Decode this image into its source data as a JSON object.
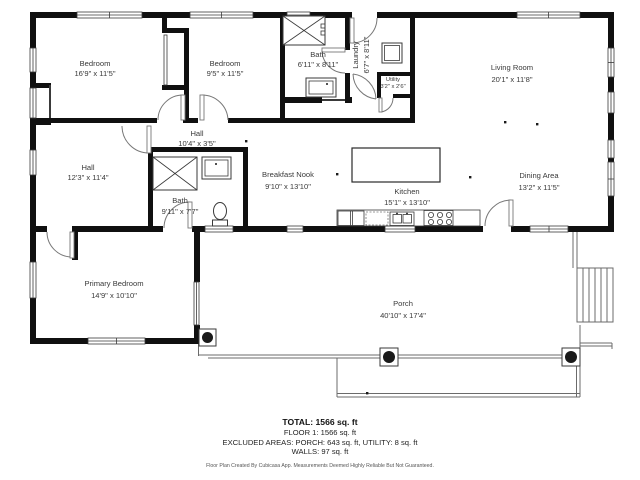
{
  "floor_plan": {
    "colors": {
      "walls": "#101010",
      "label_text": "#3a3a3a",
      "thin_lines": "#6b6b6b"
    },
    "rooms": [
      {
        "id": "bedroom-1",
        "name": "Bedroom",
        "dims": "16'9\" x 11'5\""
      },
      {
        "id": "bedroom-2",
        "name": "Bedroom",
        "dims": "9'5\" x 11'5\""
      },
      {
        "id": "bath-top",
        "name": "Bath",
        "dims": "6'11\" x 8'11\""
      },
      {
        "id": "laundry",
        "name": "Laundry",
        "dims": "6'7\" x 8'11\""
      },
      {
        "id": "utility",
        "name": "Utility",
        "dims": "3'2\" x 2'6\""
      },
      {
        "id": "living-room",
        "name": "Living Room",
        "dims": "20'1\" x 11'8\""
      },
      {
        "id": "hall-corridor",
        "name": "Hall",
        "dims": "10'4\" x 3'5\""
      },
      {
        "id": "hall",
        "name": "Hall",
        "dims": "12'3\" x 11'4\""
      },
      {
        "id": "bath-main",
        "name": "Bath",
        "dims": "9'11\" x 7'7\""
      },
      {
        "id": "breakfast-nook",
        "name": "Breakfast Nook",
        "dims": "9'10\" x 13'10\""
      },
      {
        "id": "kitchen",
        "name": "Kitchen",
        "dims": "15'1\" x 13'10\""
      },
      {
        "id": "dining-area",
        "name": "Dining Area",
        "dims": "13'2\" x 11'5\""
      },
      {
        "id": "primary-bedroom",
        "name": "Primary Bedroom",
        "dims": "14'9\" x 10'10\""
      },
      {
        "id": "porch",
        "name": "Porch",
        "dims": "40'10\" x 17'4\""
      }
    ],
    "summary": {
      "total": "TOTAL: 1566 sq. ft",
      "floor": "FLOOR 1: 1566 sq. ft",
      "excluded": "EXCLUDED AREAS: PORCH: 643 sq. ft, UTILITY: 8 sq. ft",
      "walls": "WALLS: 97 sq. ft",
      "disclaimer": "Floor Plan Created By Cubicasa App. Measurements Deemed Highly Reliable But Not Guaranteed."
    }
  }
}
